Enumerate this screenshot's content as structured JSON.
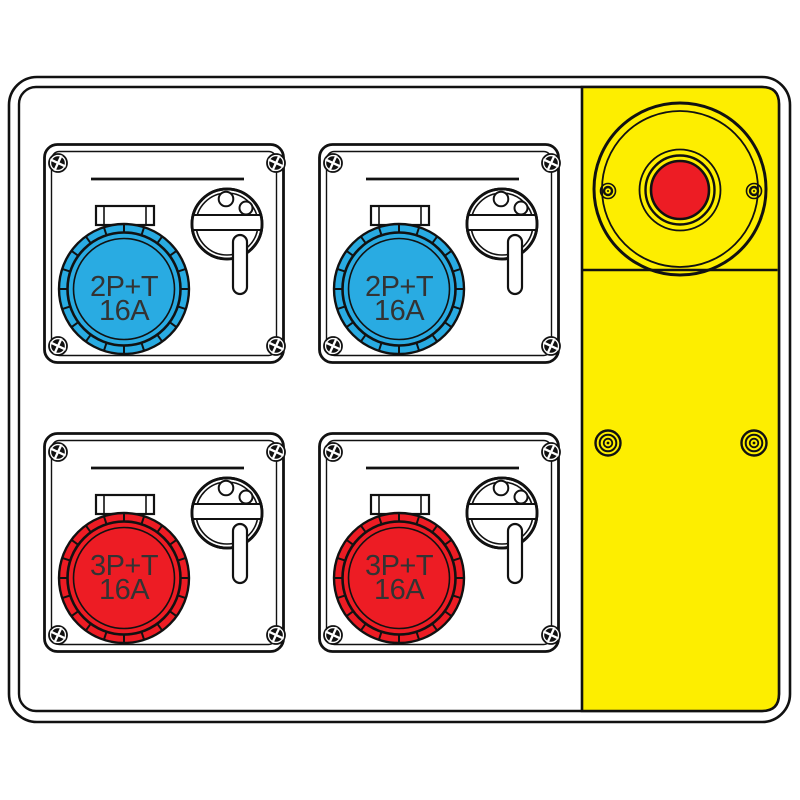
{
  "illustration": {
    "subject": "industrial distribution board with four CEE sockets and emergency stop panel",
    "background_color": "#ffffff",
    "outline_color": "#111111",
    "label_text_color": "#333333",
    "modules": [
      {
        "position": "top-left",
        "line1": "2P+T",
        "line2": "16A",
        "socket_color": "#29abe2"
      },
      {
        "position": "top-right",
        "line1": "2P+T",
        "line2": "16A",
        "socket_color": "#29abe2"
      },
      {
        "position": "bottom-left",
        "line1": "3P+T",
        "line2": "16A",
        "socket_color": "#ed1c24"
      },
      {
        "position": "bottom-right",
        "line1": "3P+T",
        "line2": "16A",
        "socket_color": "#ed1c24"
      }
    ],
    "emergency_panel": {
      "panel_color": "#fdee00",
      "button_color": "#ed1c24"
    },
    "icons": {
      "corner_screw": "phillips-screw-icon",
      "panel_screw": "small-screw-icon",
      "panel_rivet": "concentric-rivet-icon",
      "rotary_switch": "rotary-switch-lever-icon",
      "emergency_button": "round-stop-button-icon"
    }
  }
}
